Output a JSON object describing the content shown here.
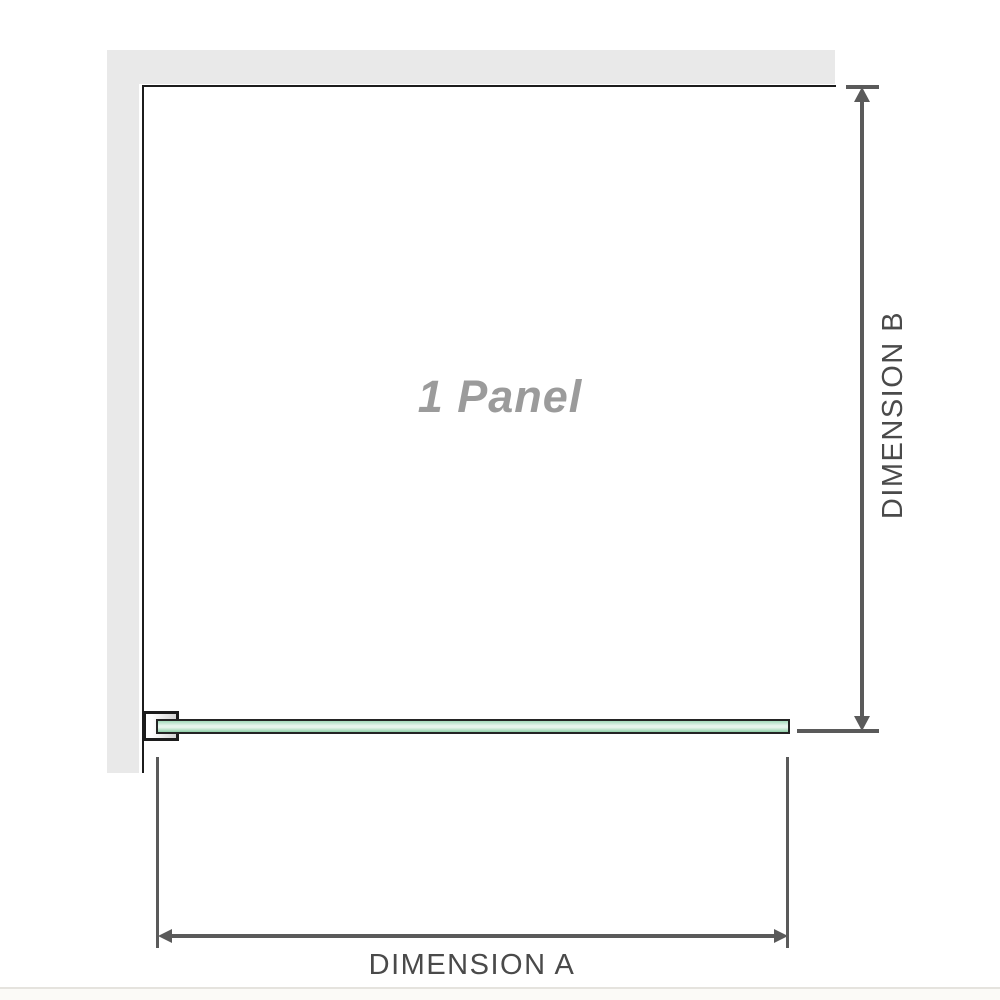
{
  "diagram": {
    "type": "shower-screen-plan-dimension-diagram",
    "panel_label": "1 Panel",
    "dimension_a_label": "DIMENSION A",
    "dimension_b_label": "DIMENSION B",
    "colors": {
      "wall": "#e9e9e9",
      "panel_outline": "#1c1c1c",
      "glass_border": "#242424",
      "glass_green": "#a3dabb",
      "glass_green_dark": "#8fd0a8",
      "glass_light": "#e7f5ed",
      "dimension_line": "#5a5a5a",
      "dimension_text": "#4a4a4a",
      "panel_text": "#9b9b9b",
      "page_footer_line": "#e5e3de"
    }
  }
}
